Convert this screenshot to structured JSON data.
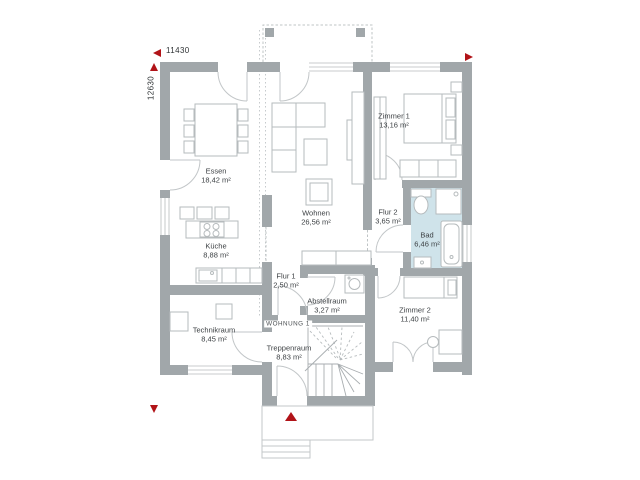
{
  "plan": {
    "title": "floor-plan",
    "dimensions": {
      "width_label": "11430",
      "height_label": "12630"
    },
    "apartment_label": "WOHNUNG 1",
    "rooms": [
      {
        "name": "Essen",
        "area": "18,42 m²"
      },
      {
        "name": "Küche",
        "area": "8,88 m²"
      },
      {
        "name": "Wohnen",
        "area": "26,56 m²"
      },
      {
        "name": "Zimmer 1",
        "area": "13,16 m²"
      },
      {
        "name": "Flur 2",
        "area": "3,65 m²"
      },
      {
        "name": "Bad",
        "area": "6,46 m²"
      },
      {
        "name": "Flur 1",
        "area": "2,50 m²"
      },
      {
        "name": "Abstellraum",
        "area": "3,27 m²"
      },
      {
        "name": "Technikraum",
        "area": "8,45 m²"
      },
      {
        "name": "Treppenraum",
        "area": "8,83 m²"
      },
      {
        "name": "Zimmer 2",
        "area": "11,40 m²"
      }
    ],
    "colors": {
      "wall": "#a1a7aa",
      "bath_floor": "#cfe3ea",
      "accent_red": "#b11318",
      "furniture_line": "#b6bbbd",
      "text": "#3d4144"
    }
  }
}
